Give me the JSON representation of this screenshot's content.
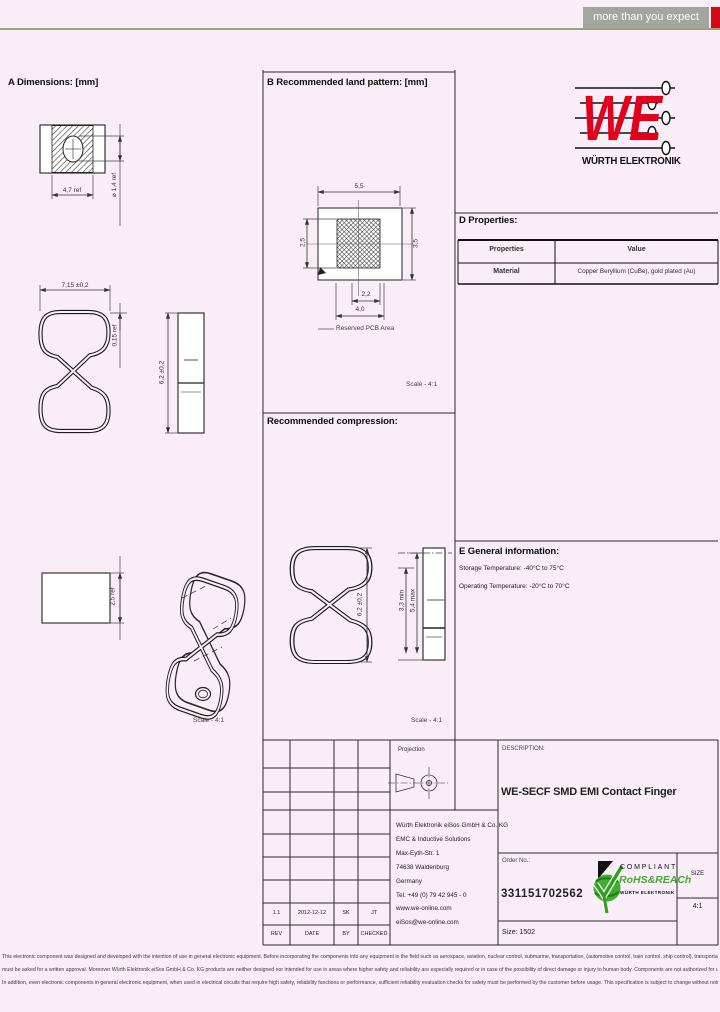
{
  "header": {
    "tagline": "more than you expect",
    "tagline_bg": "#a3a69e",
    "accent_red": "#cf0a14",
    "rule_color": "#99a27b"
  },
  "logo": {
    "we": "WE",
    "caption": "WÜRTH ELEKTRONIK",
    "red": "#e2001a"
  },
  "section_a": {
    "title": "A Dimensions: [mm]",
    "dim_top_width": "4,7 ref",
    "dim_hole": "⌀ 1,4 ref",
    "dim_width": "7,15 ±0,2",
    "dim_thickness": "0,15 ref",
    "dim_height": "6,2 ±0,2",
    "dim_depth": "2,5 ref",
    "scale": "Scale - 4:1"
  },
  "section_b": {
    "title": "B Recommended land pattern: [mm]",
    "dim_width": "5,5",
    "dim_pad_height": "2,5",
    "dim_height": "3,5",
    "dim_pad_width": "2,2",
    "dim_outer_width": "4,0",
    "reserved_label": "Reserved PCB Area",
    "scale": "Scale - 4:1"
  },
  "section_c": {
    "title": "Recommended compression:",
    "dim_free_height": "6,2 ±0,2",
    "dim_min": "3,3 min",
    "dim_max": "5,4 max",
    "scale": "Scale - 4:1"
  },
  "section_d": {
    "title": "D Properties:",
    "col_properties": "Properties",
    "col_value": "Value",
    "row_property": "Material",
    "row_value": "Copper Beryllium (CuBe), gold plated (Au)"
  },
  "section_e": {
    "title": "E General information:",
    "storage": "Storage Temperature: -40°C to 75°C",
    "operating": "Operating Temperature: -20°C to 70°C"
  },
  "titleblock": {
    "projection_label": "Projection",
    "address": [
      "Würth Elektronik eiSos GmbH & Co. KG",
      "EMC & Inductive Solutions",
      "Max-Eyth-Str. 1",
      "74638 Waldenburg",
      "Germany",
      "Tel. +49 (0) 79 42 945 - 0",
      "www.we-online.com",
      "eiSos@we-online.com"
    ],
    "description_label": "DESCRIPTION:",
    "description": "WE-SECF SMD EMI Contact Finger",
    "order_label": "Order No.:",
    "order_number": "331151702562",
    "size_label": "SIZE",
    "scale_value": "4:1",
    "size_text": "Size: 1502",
    "rev_values": {
      "rev": "1.1",
      "date": "2012-12-12",
      "by": "SK",
      "checked": "JT"
    },
    "rev_labels": {
      "rev": "REV",
      "date": "DATE",
      "by": "BY",
      "checked": "CHECKED"
    },
    "rohs": {
      "compliant": "COMPLIANT",
      "name": "RoHS&REACh",
      "brand": "WÜRTH ELEKTRONIK",
      "green": "#3fae2e"
    }
  },
  "disclaimer": {
    "line1": "This electronic component was designed and developed with the intention of use in general electronic equipment. Before incorporating the components into any equipment in the field such as aerospace, aviation, nuclear control, submarine, transportation, (automotive control, train control, ship control), transportation signal, disaster prevention, medical, public information network etc. Würth Elektronik",
    "line2": "must be asked for a written approval. Moreover Würth Elektronik eiSos GmbH & Co. KG products are neither designed nor intended for use in areas where higher safety and reliability are especially required or in case of the possibility of direct damage or injury to human body. Components are not authorized for use in such applications unless agreed in writing.",
    "line3": "In addition, even electronic components in general electronic equipment, when used in electrical circuits that require high safety, reliability functions or performance, sufficient reliability evaluation checks for safety must be performed by the customer before usage. This specification is subject to change without notice."
  }
}
